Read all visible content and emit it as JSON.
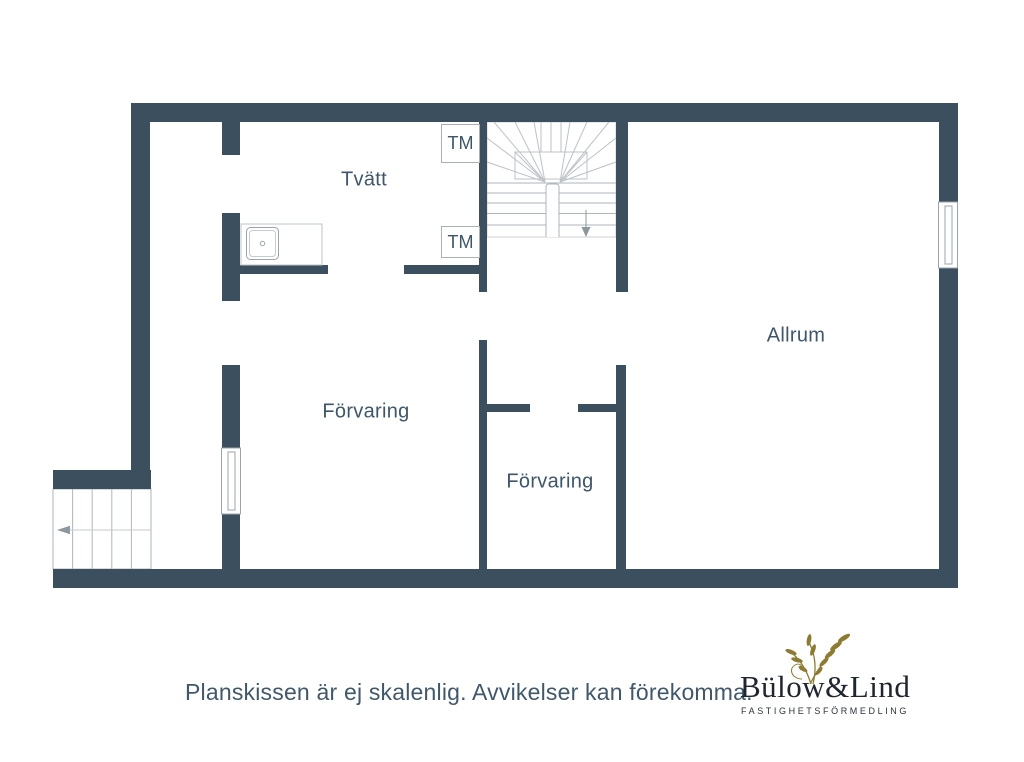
{
  "plan": {
    "rooms": [
      {
        "label": "Tvätt"
      },
      {
        "label": "Allrum"
      },
      {
        "label": "Förvaring"
      },
      {
        "label": "Förvaring"
      }
    ],
    "appliances": [
      {
        "label": "TM"
      },
      {
        "label": "TM"
      }
    ]
  },
  "footer": {
    "disclaimer": "Planskissen är ej skalenlig. Avvikelser kan förekomma."
  },
  "logo": {
    "name": "Bülow&Lind",
    "tagline": "FASTIGHETSFÖRMEDLING"
  },
  "colors": {
    "wall_color": "#3b4f5e",
    "label_color": "#3f5668",
    "stair_line": "#aeb6bc",
    "logo_gold": "#8d7b33",
    "logo_text": "#20262e"
  }
}
